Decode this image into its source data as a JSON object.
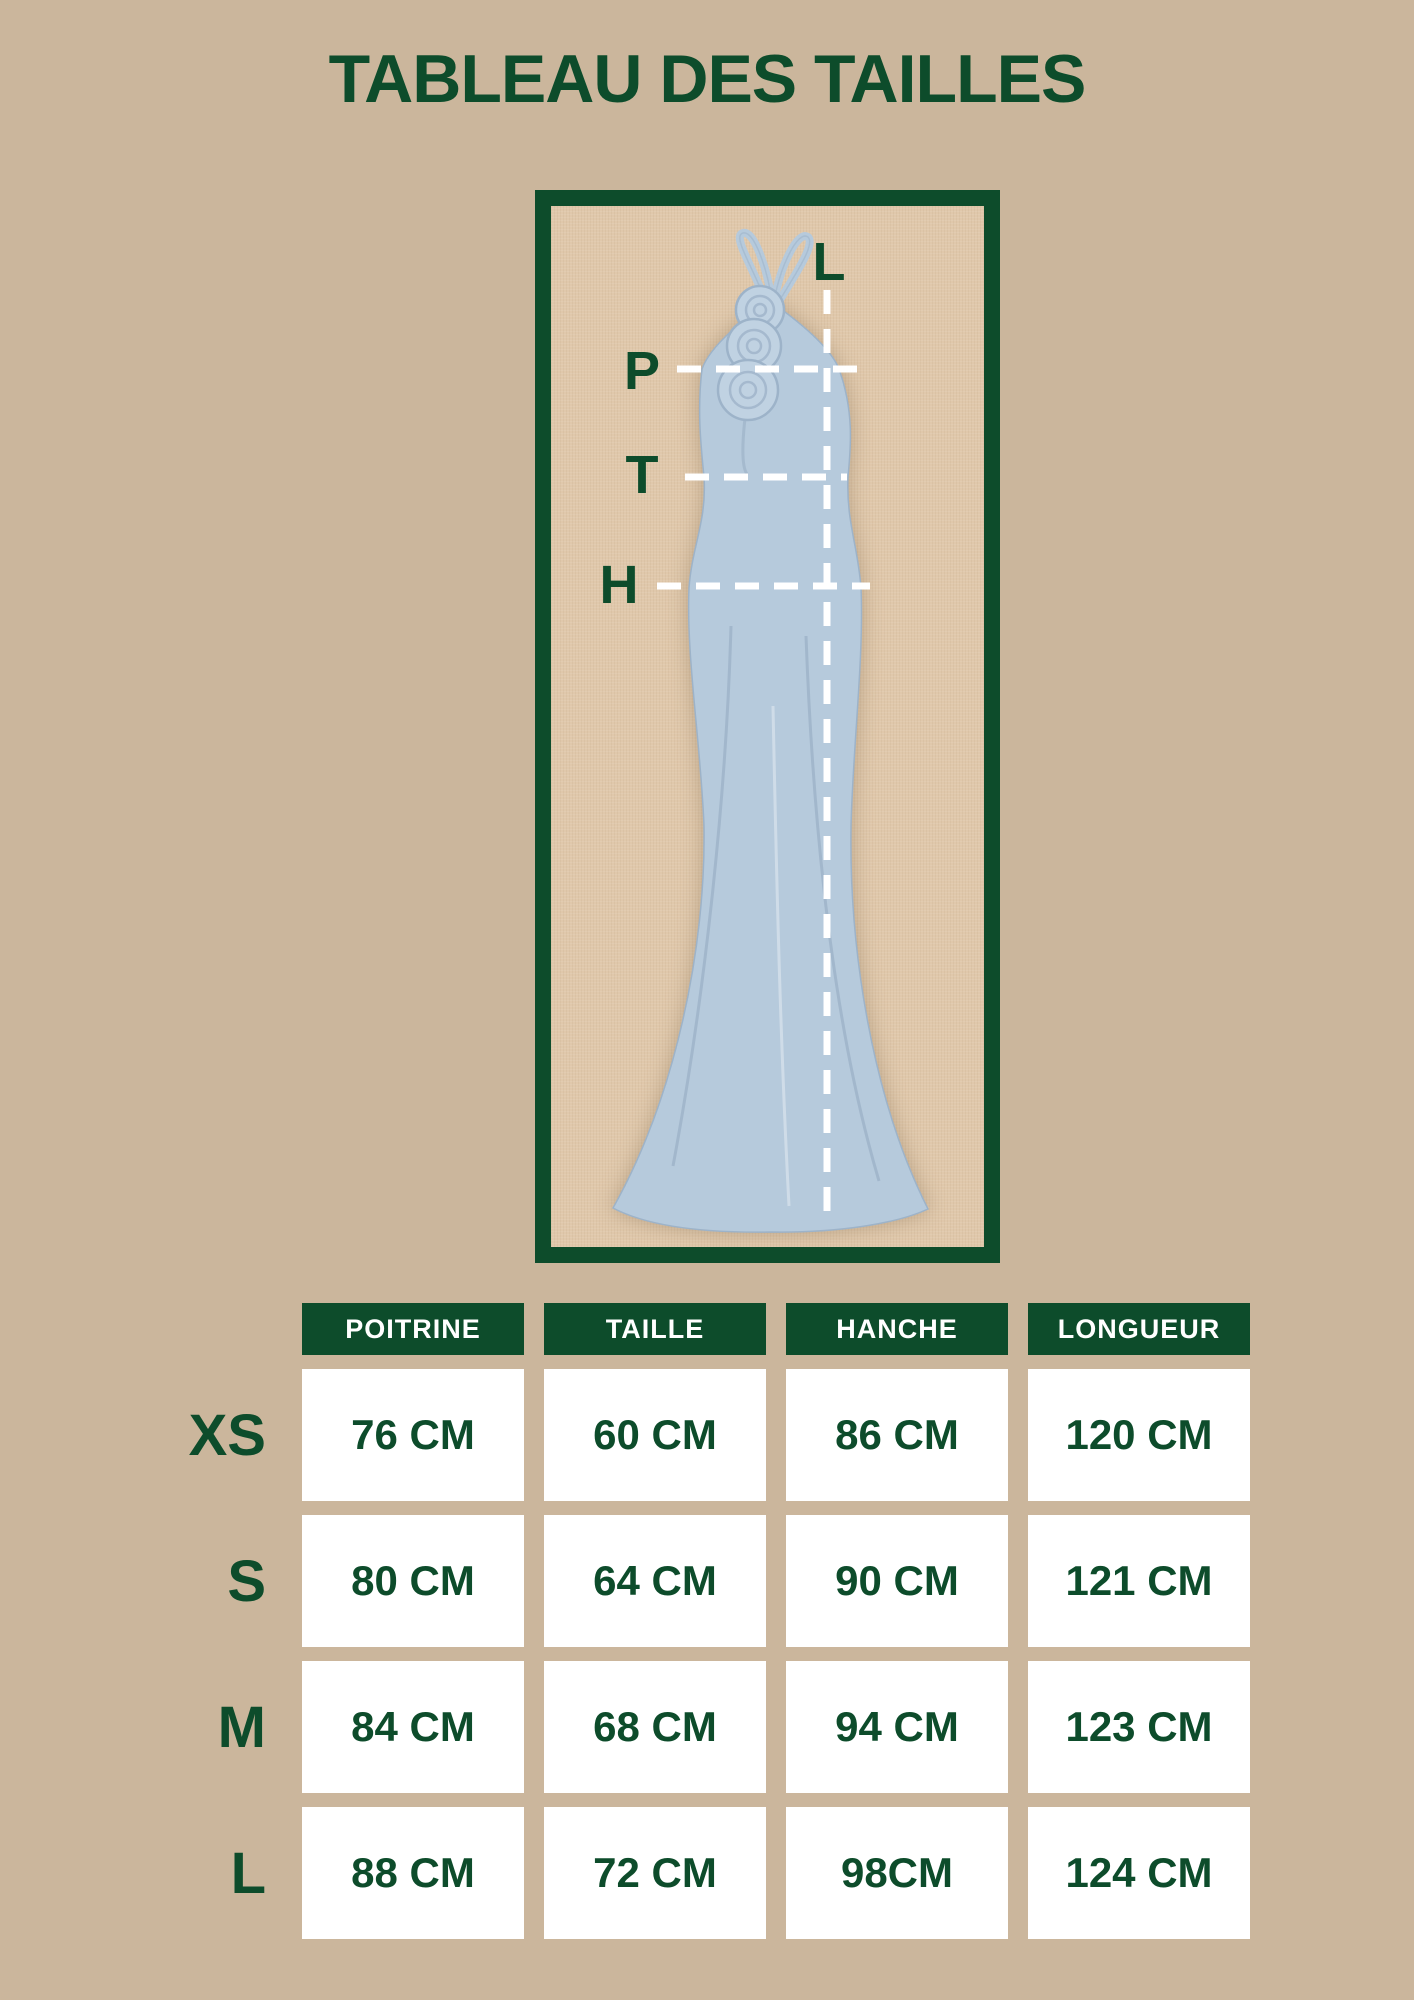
{
  "page": {
    "title": "TABLEAU DES TAILLES"
  },
  "diagram": {
    "labels": {
      "length": "L",
      "chest": "P",
      "waist": "T",
      "hip": "H"
    }
  },
  "size_table": {
    "columns": [
      "POITRINE",
      "TAILLE",
      "HANCHE",
      "LONGUEUR"
    ],
    "rows": [
      {
        "size": "XS",
        "values": [
          "76 CM",
          "60 CM",
          "86 CM",
          "120 CM"
        ]
      },
      {
        "size": "S",
        "values": [
          "80 CM",
          "64 CM",
          "90 CM",
          "121 CM"
        ]
      },
      {
        "size": "M",
        "values": [
          "84 CM",
          "68 CM",
          "94 CM",
          "123 CM"
        ]
      },
      {
        "size": "L",
        "values": [
          "88 CM",
          "72 CM",
          "98CM",
          "124 CM"
        ]
      }
    ]
  },
  "colors": {
    "accent_green": "#0d4c2b",
    "background": "#cbb69c",
    "panel_linen": "#e0c8ab",
    "dress_blue": "#b6cadc",
    "dress_shade": "#9db3c9",
    "cell_white": "#ffffff"
  }
}
